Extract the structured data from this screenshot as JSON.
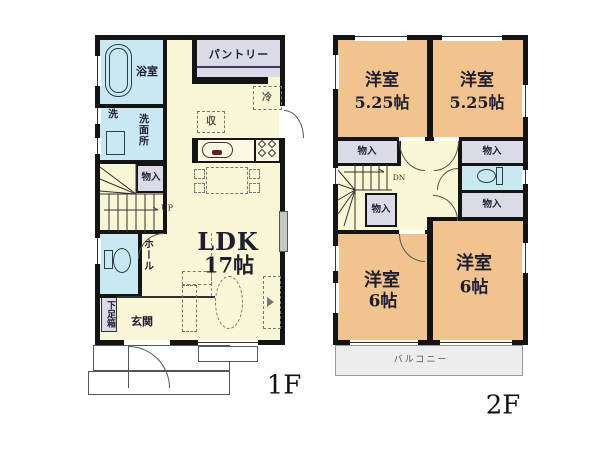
{
  "f1": {
    "floor_label": "1F",
    "pantry": "パントリー",
    "bath": "浴室",
    "washer": "洗",
    "washroom": "洗面所",
    "closet": "物入",
    "stairs": "UP",
    "hall": "ホール",
    "shoe_cabinet": "下足箱",
    "entrance": "玄関",
    "ldk_name": "LDK",
    "ldk_size": "17帖",
    "fridge": "冷",
    "storage": "収"
  },
  "f2": {
    "floor_label": "2F",
    "rooms": [
      {
        "name": "洋室",
        "size": "5.25帖"
      },
      {
        "name": "洋室",
        "size": "5.25帖"
      },
      {
        "name": "洋室",
        "size": "6帖"
      },
      {
        "name": "洋室",
        "size": "6帖"
      }
    ],
    "closets": [
      "物入",
      "物入",
      "物入",
      "物入"
    ],
    "stairs": "DN",
    "balcony": "バルコニー"
  },
  "colors": {
    "floor_1f_hall": "#FAF7D6",
    "floor_2f_room": "#F0C48C",
    "wet_area": "#C8E9F1",
    "closet": "#DBDBE7",
    "balcony": "#EDEDED",
    "wall": "#141414"
  }
}
